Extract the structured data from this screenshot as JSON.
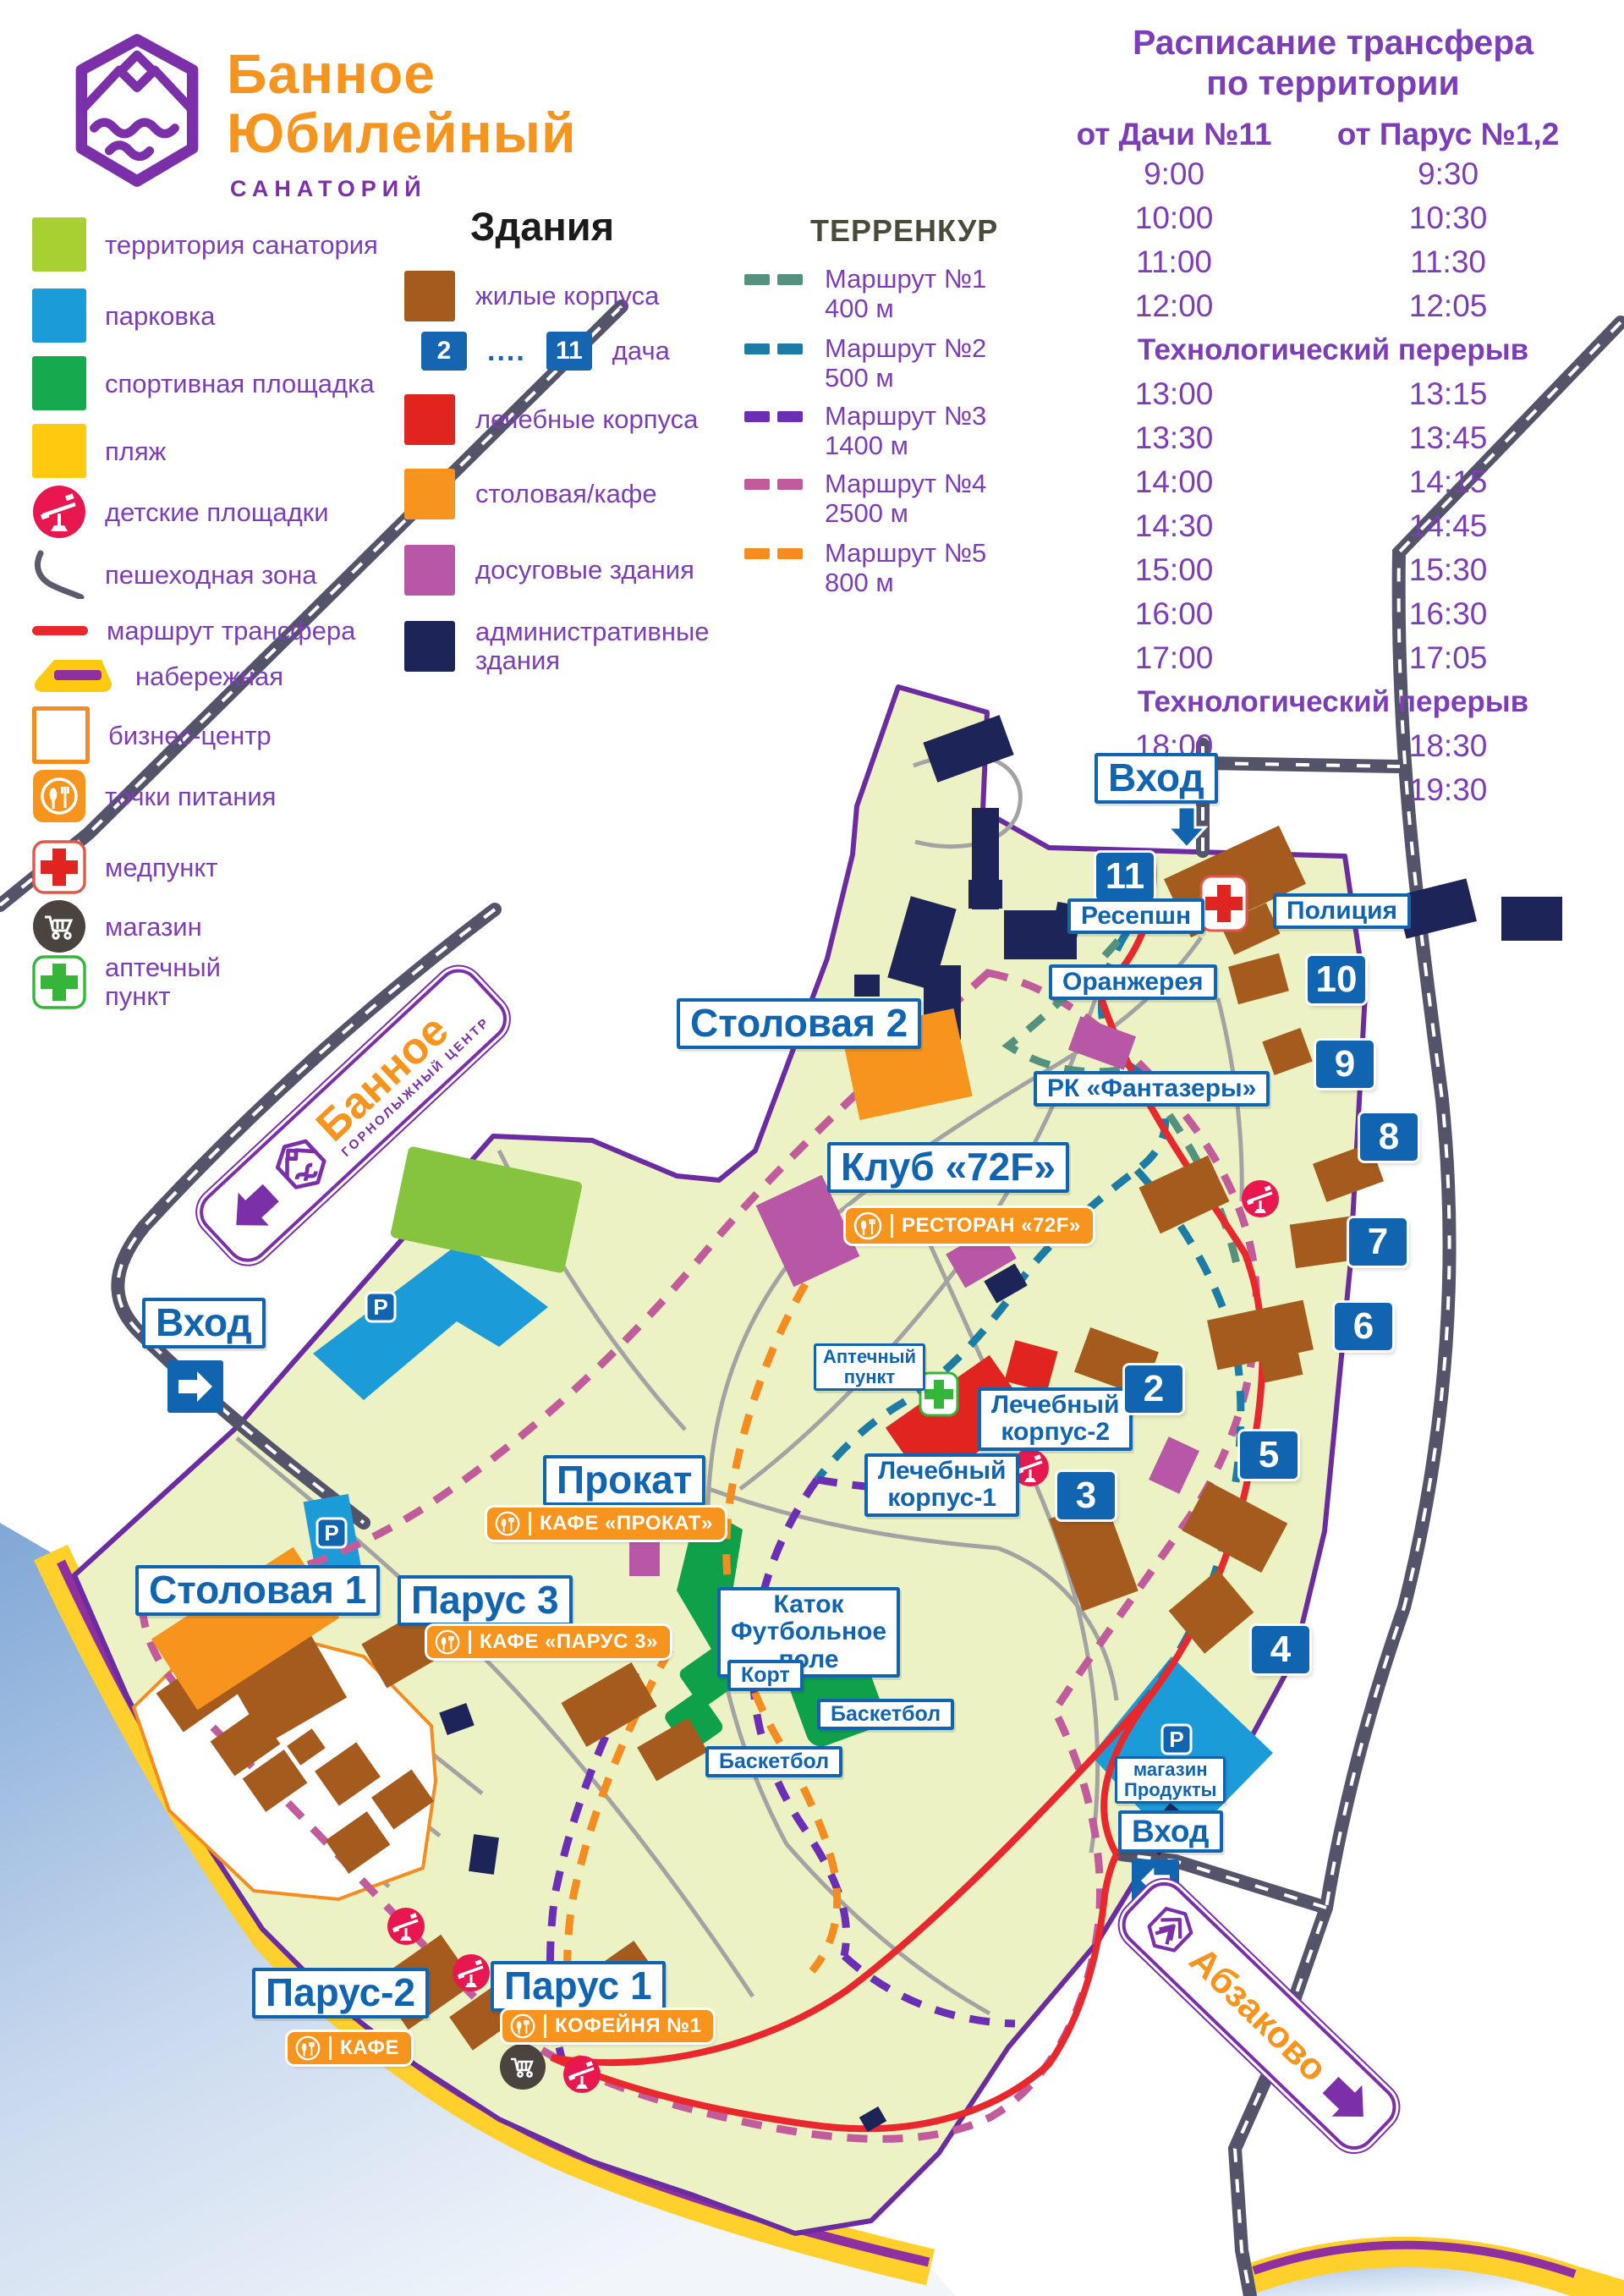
{
  "logo": {
    "line1": "Банное",
    "line2": "Юбилейный",
    "subtitle": "САНАТОРИЙ"
  },
  "legend": {
    "items": [
      {
        "label": "территория санатория",
        "color": "#a9d033"
      },
      {
        "label": "парковка",
        "color": "#1b9cd8"
      },
      {
        "label": "спортивная площадка",
        "color": "#17a94e"
      },
      {
        "label": "пляж",
        "color": "#ffc910"
      },
      {
        "label": "детские площадки",
        "color": "#e8174f"
      },
      {
        "label": "пешеходная зона",
        "color": "#5b5b6e"
      },
      {
        "label": "маршрут трансфера",
        "color": "#e8282c"
      },
      {
        "label": "набережная",
        "color": "#8f2fa0"
      },
      {
        "label": "бизнес-центр",
        "color": "#f68b1f"
      },
      {
        "label": "точки питания",
        "color": "#f7941d"
      },
      {
        "label": "медпункт",
        "color": "#e02420"
      },
      {
        "label": "магазин",
        "color": "#4b443e"
      },
      {
        "label": "аптечный пункт",
        "color": "#35b53a"
      }
    ]
  },
  "buildings": {
    "title": "Здания",
    "items": [
      {
        "label": "жилые корпуса",
        "color": "#a55b1d"
      },
      {
        "label": "лечебные корпуса",
        "color": "#e02420"
      },
      {
        "label": "столовая/кафе",
        "color": "#f7941d"
      },
      {
        "label": "досуговые здания",
        "color": "#b757a5"
      },
      {
        "label": "административные здания",
        "color": "#1d2558"
      }
    ],
    "dacha": {
      "from": "2",
      "to": "11",
      "dots": "....",
      "label": "дача",
      "color": "#1565b0"
    }
  },
  "terrenkur": {
    "title": "ТЕРРЕНКУР",
    "routes": [
      {
        "name": "Маршрут №1",
        "length": "400 м",
        "color": "#55917f"
      },
      {
        "name": "Маршрут №2",
        "length": "500 м",
        "color": "#1c7ca6"
      },
      {
        "name": "Маршрут №3",
        "length": "1400 м",
        "color": "#6a2fb5"
      },
      {
        "name": "Маршрут №4",
        "length": "2500 м",
        "color": "#c25b9c"
      },
      {
        "name": "Маршрут №5",
        "length": "800 м",
        "color": "#f68b1f"
      }
    ]
  },
  "schedule": {
    "title1": "Расписание трансфера",
    "title2": "по территории",
    "col_left": "от Дачи №11",
    "col_right": "от Парус №1,2",
    "rows": [
      {
        "left": "9:00",
        "right": "9:30"
      },
      {
        "left": "10:00",
        "right": "10:30"
      },
      {
        "left": "11:00",
        "right": "11:30"
      },
      {
        "left": "12:00",
        "right": "12:05"
      },
      {
        "text": "Технологический перерыв"
      },
      {
        "left": "13:00",
        "right": "13:15"
      },
      {
        "left": "13:30",
        "right": "13:45"
      },
      {
        "left": "14:00",
        "right": "14:15"
      },
      {
        "left": "14:30",
        "right": "14:45"
      },
      {
        "left": "15:00",
        "right": "15:30"
      },
      {
        "left": "16:00",
        "right": "16:30"
      },
      {
        "left": "17:00",
        "right": "17:05"
      },
      {
        "text": "Технологический перерыв"
      },
      {
        "left": "18:00",
        "right": "18:30"
      },
      {
        "left": "19:00",
        "right": "19:30"
      }
    ]
  },
  "map": {
    "entrance_top": "Вход",
    "entrance_left": "Вход",
    "entrance_bottom": "Вход",
    "reception": "Ресепшн",
    "police": "Полиция",
    "orangery": "Оранжерея",
    "fantasery": "РК «Фантазеры»",
    "stolovaya2": "Столовая 2",
    "stolovaya1": "Столовая 1",
    "club72f": "Клуб «72F»",
    "restoran72f": "РЕСТОРАН «72F»",
    "apteka1": "Аптечный",
    "apteka2": "пункт",
    "korpus2a": "Лечебный",
    "korpus2b": "корпус-2",
    "korpus1a": "Лечебный",
    "korpus1b": "корпус-1",
    "prokat": "Прокат",
    "cafe_prokat": "КАФЕ «ПРОКАТ»",
    "parus3": "Парус 3",
    "cafe_parus3": "КАФЕ «ПАРУС 3»",
    "katok1": "Каток",
    "katok2": "Футбольное",
    "katok3": "поле",
    "kort": "Корт",
    "basket1": "Баскетбол",
    "basket2": "Баскетбол",
    "shop1": "магазин",
    "shop2": "Продукты",
    "parus2": "Парус-2",
    "cafe_parus2": "КАФЕ",
    "parus1": "Парус 1",
    "coffee1": "КОФЕЙНЯ №1",
    "n11": "11",
    "n10": "10",
    "n9": "9",
    "n8": "8",
    "n7": "7",
    "n6": "6",
    "n5": "5",
    "n4": "4",
    "n3": "3",
    "n2": "2",
    "parking_p": "P",
    "sign_bannoe": "Банное",
    "sign_bannoe_sub": "ГОРНОЛЫЖНЫЙ ЦЕНТР",
    "sign_abzakovo": "Абзаково"
  }
}
